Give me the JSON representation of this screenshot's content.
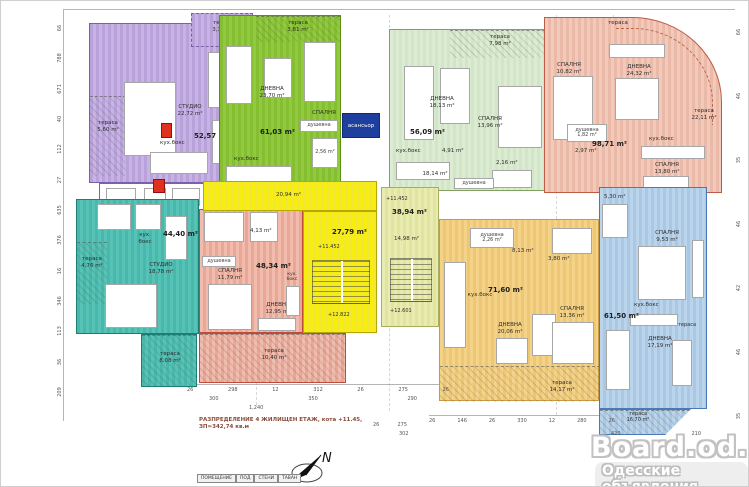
{
  "plan": {
    "caption_line1": "РАЗПРЕДЕЛЕНИЕ 4 ЖИЛИЩЕН ЕТАЖ, кота +11.45,",
    "caption_line2": "ЗП=342,74 кв.м",
    "compass_label": "N",
    "elevator_label": "асансьор",
    "elevator_colors": {
      "c1": "#1f3f9f",
      "c2": "#1f3f9f",
      "wall": "#122a6e"
    },
    "shaft_colors": {
      "c1": "#e03020"
    }
  },
  "apartments": {
    "purple": {
      "colors": {
        "c1": "#b9a2da",
        "c2": "#c7b4e4",
        "wall": "#7b5fa8"
      },
      "area": "52,57 m²",
      "studio": "СТУДИО\n22,72 m²",
      "terrace_left": "тераса\n5,60 m²",
      "terrace_top": "тераса\n3,30 m²",
      "kitchen": "кух.бокс",
      "bath1": "3,34 m²",
      "bath2": "4,38 m²"
    },
    "green": {
      "colors": {
        "c1": "#85be30",
        "c2": "#91c940",
        "wall": "#5b8f12"
      },
      "area": "61,03 m²",
      "living": "ДНЕВНА\n23,70 m²",
      "bedroom": "СПАЛНЯ",
      "terrace_top": "тераса\n3,81 m²",
      "kitchen": "кух.бокс",
      "shower": "душевна",
      "wc": "2,56 m²"
    },
    "lightgreen": {
      "colors": {
        "c1": "#dcecd2",
        "c2": "#d2e5c7",
        "wall": "#7fa35e"
      },
      "area": "56,09 m²",
      "living": "ДНЕВНА\n18,13 m²",
      "bedroom": "СПАЛНЯ\n13,96 m²",
      "terrace_top": "тераса\n7,98 m²",
      "kitchen": "кух.бокс",
      "hall": "4,91 m²",
      "bath": "2,16 m²",
      "shower": "душевна"
    },
    "pink": {
      "colors": {
        "c1": "#f2cabb",
        "c2": "#eab9a7",
        "wall": "#bf5a44"
      },
      "area": "98,71 m²",
      "living": "ДНЕВНА\n24,32 m²",
      "bedroom1": "СПАЛНЯ\n10,82 m²",
      "bedroom2": "СПАЛНЯ\n13,80 m²",
      "terrace_top": "тераса",
      "terrace_arc": "тераса\n22,11 m²",
      "shower": "душевна\n1,82 m²",
      "bath": "2,97 m²",
      "kitchen": "кух.бокс"
    },
    "teal": {
      "colors": {
        "c1": "#49b8ac",
        "c2": "#57c2b6",
        "wall": "#1f7d74"
      },
      "area": "44,40 m²",
      "studio": "СТУДИО\n18,78 m²",
      "terrace_left": "тераса\n4,76 m²",
      "terrace_bottom": "тераса\n8,08 m²",
      "kitchen": "кух.\nбокс"
    },
    "red": {
      "colors": {
        "c1": "#f1bcae",
        "c2": "#e9a795",
        "wall": "#c14b3a"
      },
      "area": "48,34 m²",
      "bedroom": "СПАЛНЯ\n11,79 m²",
      "living": "ДНЕВНА\n12,95 m²",
      "terrace_bottom": "тераса\n10,40 m²",
      "kitchen": "кух.\nбокс",
      "shower": "душевна",
      "hall": "4,13 m²"
    },
    "orange": {
      "colors": {
        "c1": "#f4d389",
        "c2": "#eec775",
        "wall": "#c99a3f"
      },
      "area": "71,60 m²",
      "living": "ДНЕВНА\n20,06 m²",
      "bedroom": "СПАЛНЯ\n13,36 m²",
      "terrace_bottom": "тераса\n14,17 m²",
      "kitchen": "кух.бокс",
      "shower": "душевна\n2,26 m²",
      "hall": "8,13 m²",
      "bath": "3,80 m²"
    },
    "blue": {
      "colors": {
        "c1": "#bad4eb",
        "c2": "#aac7e3",
        "wall": "#4a7ab5"
      },
      "area": "61,50 m²",
      "living": "ДНЕВНА\n17,19 m²",
      "bedroom": "СПАЛНЯ\n9,53 m²",
      "terrace_right": "тераса",
      "terrace_bottom": "тераса\n16,70 m²",
      "kitchen": "кух.бокс",
      "balcony": "5,30 m²"
    }
  },
  "stairs": {
    "yellow": {
      "colors": {
        "c1": "#f7ee10",
        "c2": "#f1e73c",
        "wall": "#b8a700"
      },
      "area": "27,79 m²",
      "hall": "20,94 m²",
      "level_top": "+11.452",
      "level_bottom": "+12.822"
    },
    "lime": {
      "colors": {
        "c1": "#e9ecb0",
        "c2": "#e1e49c",
        "wall": "#a9ae5e"
      },
      "area": "38,94 m²",
      "inner": "14,98 m²",
      "level_top": "+11.452",
      "level_bottom": "+12.601",
      "corridor": "18,14 m²"
    }
  },
  "dimensions": {
    "left_col": [
      "66",
      "788",
      "671",
      "40",
      "112",
      "27",
      "635",
      "376",
      "16",
      "346",
      "113",
      "36",
      "209"
    ],
    "right_col": [
      "66",
      "46",
      "35",
      "46",
      "42",
      "46",
      "35"
    ],
    "bottom_row1": [
      "26",
      "298",
      "12",
      "312",
      "26",
      "275",
      "26"
    ],
    "bottom_row2": [
      "300",
      "350",
      "290"
    ],
    "bottom_total": "1,240",
    "bottom_right": [
      "26",
      "146",
      "26",
      "330",
      "12",
      "280",
      "26"
    ],
    "right_small_a": [
      "26",
      "275"
    ],
    "right_small_b": "302",
    "right_mid": [
      "420",
      "210"
    ]
  },
  "legend_table": {
    "headers": [
      "ПОМЕЩЕНИЕ",
      "ПОД",
      "СТЕНИ",
      "ТАВАН"
    ]
  },
  "watermark": {
    "title": "Board.od.ua",
    "subtitle": "Одесские объявления"
  }
}
